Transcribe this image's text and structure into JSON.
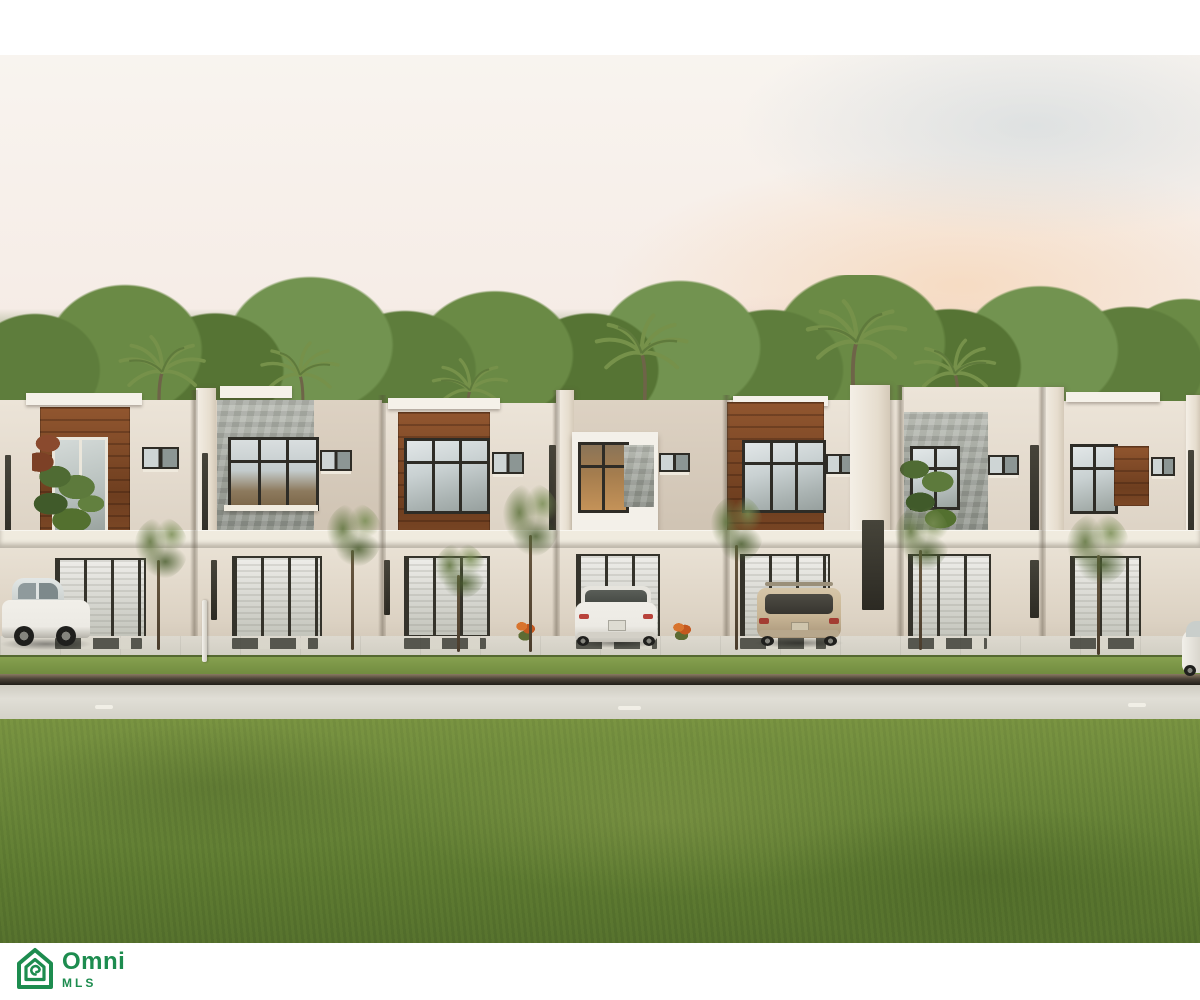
{
  "branding": {
    "logo_text": "Omni",
    "logo_subtext": "MLS",
    "logo_icon": "house-spiral-icon"
  },
  "photo": {
    "alt": "Rendering of a row of modern two-story townhomes with wood and stone accents, palm trees and pink sunset sky, cars parked in front, wide green lawn"
  },
  "scene": {
    "colors": {
      "sky_top": "#f8f4ef",
      "sky_mauve": "#d5afc8",
      "cloud_peach": "#f3c9a2",
      "cloud_mauve": "#c08ba4",
      "tree_green": "#64823f",
      "palm_green": "#76914a",
      "wall_cream": "#ece4d8",
      "wall_shadow": "#d8cfc1",
      "wood_accent": "#6e3e1f",
      "stone_accent": "#9a9e96",
      "frame_dark": "#2e2c26",
      "glass_light": "#c9d1d2",
      "warm_interior": "#c49258",
      "sidewalk": "#d2cfc4",
      "curb_dark": "#211d18",
      "road": "#e0ded6",
      "grass_strip": "#6f8a3e",
      "lawn": "#6b873a",
      "car_white": "#eceae4",
      "car_tan": "#c8b595",
      "logo_green": "#1d8c4f"
    }
  }
}
